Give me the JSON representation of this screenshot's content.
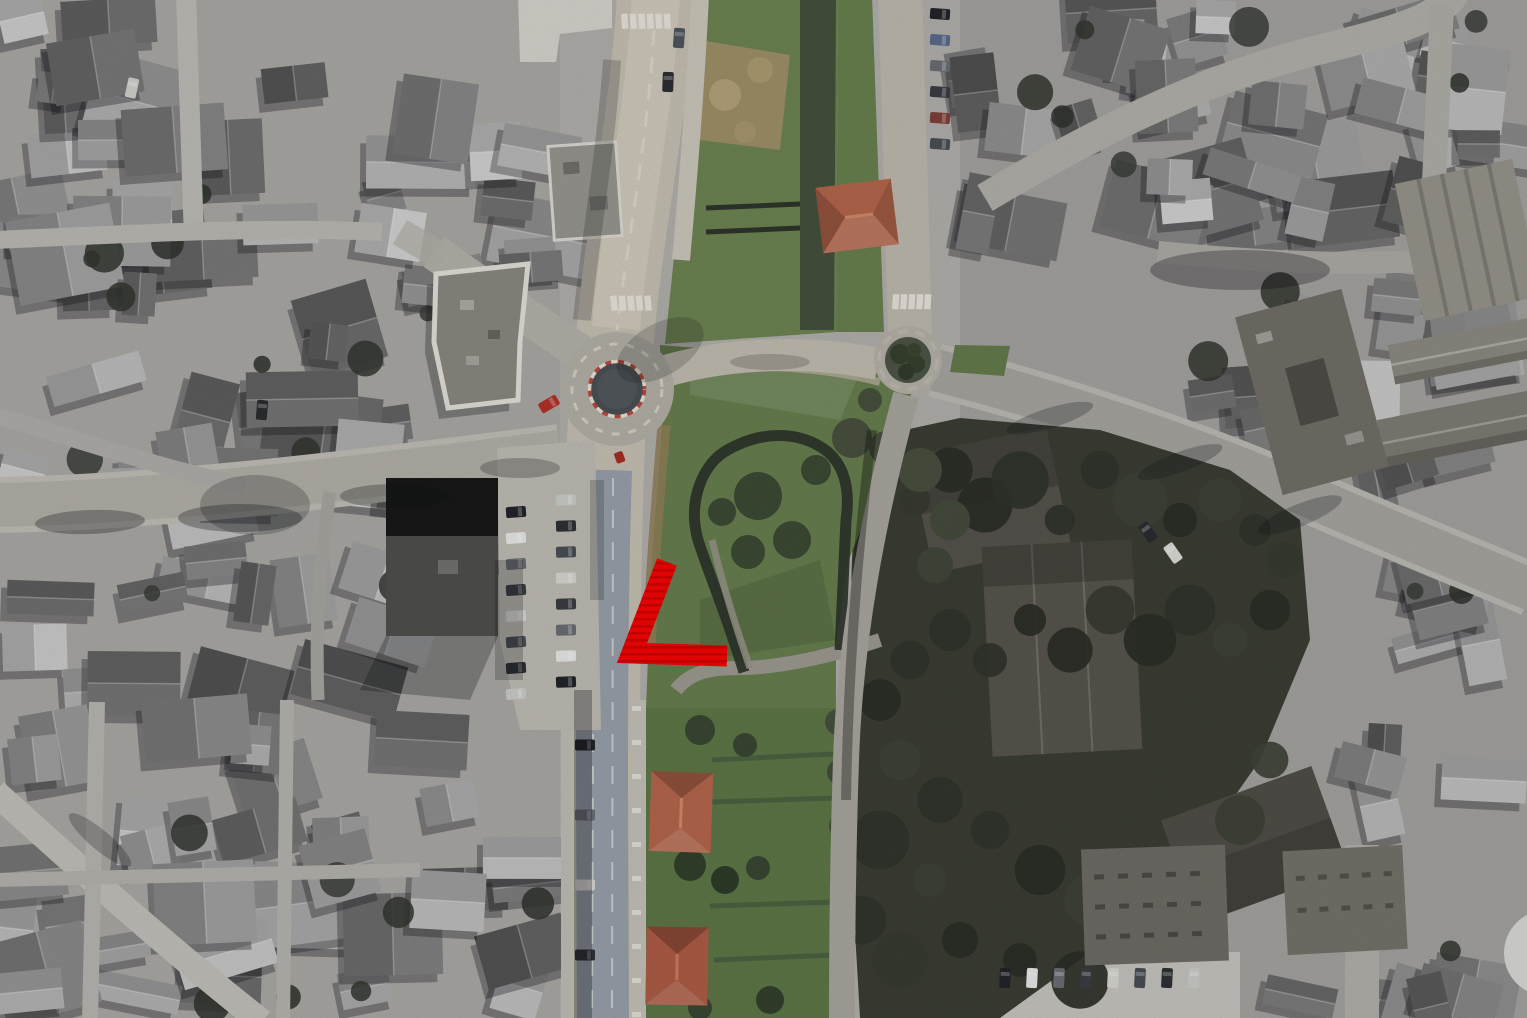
{
  "view": {
    "type": "aerial-satellite-photo",
    "style": "grayscale city with colorized central corridor"
  },
  "annotation_marker": {
    "name": "red-angle-marker",
    "color": "#f50505",
    "stripe_color": "#d40000",
    "points": "667,562 632,653 727,656",
    "stroke_width": 21
  },
  "map_control": {
    "icon": "person-icon",
    "background": "#d9d9d7",
    "icon_color": "#2e2e2e",
    "cx": 1547,
    "cy": 953,
    "r": 43
  },
  "palette": {
    "ground": "#b2b0ac",
    "road": "#c6c0b3",
    "road_top": "#d0cabc",
    "asphalt": "#98a0aa",
    "lawn": "#677e4e",
    "lawn_top": "#6d8452",
    "gardens": "#5d7747",
    "woods": "#3b3e34",
    "tree": "#3c4a34",
    "roof_red": "#b4664c",
    "wall_dark": "#2d332a",
    "roundabout_island": "#4b5054",
    "curb_red": "#b94a40",
    "curb_white": "#e8e1d4"
  }
}
